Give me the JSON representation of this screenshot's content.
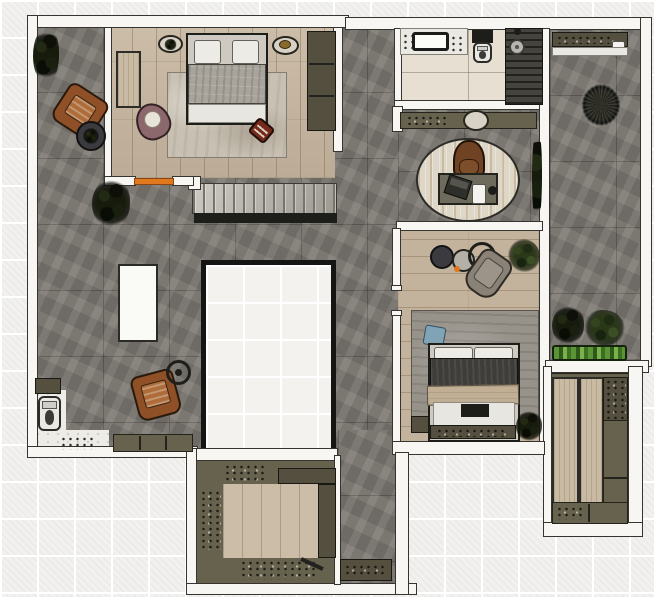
{
  "meta": {
    "title": "apartment-floor-plan-top-view-render",
    "canvas": {
      "width": 654,
      "height": 597
    }
  },
  "palette": {
    "background_tile": "#f2f1ef",
    "wall_white": "#f7f6f3",
    "concrete_gray": "#7b7670",
    "wood_light": "#c6b59f",
    "cabinet_olive": "#66624e",
    "accent_orange": "#e0781e",
    "plant_green": "#2a3818",
    "duvet_dark": "#3e3d3a",
    "leather_brown": "#8f5027"
  },
  "scene": [
    {
      "n": "living-room-floor",
      "c": "concrete",
      "x": 37,
      "y": 27,
      "w": 361,
      "h": 425
    },
    {
      "n": "corridor-bottom-floor",
      "c": "concrete",
      "x": 338,
      "y": 430,
      "w": 57,
      "h": 156
    },
    {
      "n": "office-floor",
      "c": "concrete",
      "x": 398,
      "y": 106,
      "w": 142,
      "h": 124
    },
    {
      "n": "bedroom-1-floor",
      "c": "wood-v",
      "x": 108,
      "y": 27,
      "w": 227,
      "h": 151
    },
    {
      "n": "bedroom-2-floor",
      "c": "wood-h",
      "x": 398,
      "y": 230,
      "w": 142,
      "h": 214
    },
    {
      "n": "bathroom-floor",
      "c": "tile-bath",
      "x": 398,
      "y": 28,
      "w": 145,
      "h": 78
    },
    {
      "n": "balcony-floor",
      "c": "concrete",
      "x": 550,
      "y": 30,
      "w": 94,
      "h": 332
    },
    {
      "n": "closet-floor",
      "c": "olive",
      "x": 549,
      "y": 373,
      "w": 82,
      "h": 152
    },
    {
      "n": "kitchen-floor",
      "c": "olive",
      "x": 196,
      "y": 460,
      "w": 140,
      "h": 124
    },
    {
      "n": "kitchen-wood-floor",
      "c": "wood-v2",
      "x": 223,
      "y": 484,
      "w": 95,
      "h": 74
    },
    {
      "n": "wc-floor-left",
      "c": "marble",
      "x": 33,
      "y": 390,
      "w": 33,
      "h": 62
    },
    {
      "n": "wc-floor-bottom",
      "c": "marble",
      "x": 33,
      "y": 430,
      "w": 76,
      "h": 22
    },
    {
      "n": "staircase",
      "c": "stairs",
      "x": 192,
      "y": 183,
      "w": 145,
      "h": 31
    },
    {
      "n": "staircase-edge",
      "c": "edge-dark",
      "x": 194,
      "y": 213,
      "w": 143,
      "h": 10
    },
    {
      "n": "stair-newel-cap",
      "c": "wall",
      "x": 188,
      "y": 176,
      "w": 13,
      "h": 14
    },
    {
      "n": "floor-void",
      "c": "void",
      "x": 201,
      "y": 260,
      "w": 135,
      "h": 194
    },
    {
      "n": "island-table",
      "c": "white-box",
      "x": 118,
      "y": 264,
      "w": 40,
      "h": 78
    },
    {
      "n": "wall-top-left",
      "c": "wall",
      "x": 27,
      "y": 15,
      "w": 322,
      "h": 13
    },
    {
      "n": "wall-top-right",
      "c": "wall",
      "x": 345,
      "y": 17,
      "w": 305,
      "h": 13
    },
    {
      "n": "wall-left",
      "c": "wall",
      "x": 27,
      "y": 15,
      "w": 11,
      "h": 440
    },
    {
      "n": "wall-living-bottom",
      "c": "wall",
      "x": 27,
      "y": 446,
      "w": 171,
      "h": 12
    },
    {
      "n": "wall-bedroom1-left",
      "c": "wall",
      "x": 104,
      "y": 27,
      "w": 8,
      "h": 152
    },
    {
      "n": "wall-bedroom1-bottom-a",
      "c": "wall",
      "x": 104,
      "y": 176,
      "w": 32,
      "h": 10
    },
    {
      "n": "wall-bedroom1-bottom-b",
      "c": "wall",
      "x": 172,
      "y": 176,
      "w": 22,
      "h": 10
    },
    {
      "n": "door-sill-bedroom1",
      "c": "orange",
      "x": 134,
      "y": 178,
      "w": 40,
      "h": 7
    },
    {
      "n": "wall-bedroom1-right",
      "c": "wall",
      "x": 333,
      "y": 27,
      "w": 10,
      "h": 125
    },
    {
      "n": "wall-bathroom-left",
      "c": "wall",
      "x": 394,
      "y": 28,
      "w": 8,
      "h": 78
    },
    {
      "n": "wall-bathroom-bottom",
      "c": "wall",
      "x": 394,
      "y": 100,
      "w": 150,
      "h": 10
    },
    {
      "n": "wall-office-tab",
      "c": "wall",
      "x": 392,
      "y": 106,
      "w": 11,
      "h": 26
    },
    {
      "n": "wall-mid-right",
      "c": "wall",
      "x": 539,
      "y": 28,
      "w": 11,
      "h": 424
    },
    {
      "n": "wall-balcony-right",
      "c": "wall",
      "x": 640,
      "y": 17,
      "w": 12,
      "h": 350
    },
    {
      "n": "wall-closet-top",
      "c": "wall",
      "x": 545,
      "y": 360,
      "w": 104,
      "h": 13
    },
    {
      "n": "wall-closet-right",
      "c": "wall",
      "x": 628,
      "y": 366,
      "w": 15,
      "h": 170
    },
    {
      "n": "wall-closet-left",
      "c": "wall",
      "x": 543,
      "y": 366,
      "w": 9,
      "h": 170
    },
    {
      "n": "wall-closet-bottom",
      "c": "wall",
      "x": 543,
      "y": 522,
      "w": 100,
      "h": 15
    },
    {
      "n": "wall-office-bedroom2",
      "c": "wall",
      "x": 396,
      "y": 221,
      "w": 147,
      "h": 10
    },
    {
      "n": "wall-living-right-upper",
      "c": "wall",
      "x": 392,
      "y": 228,
      "w": 9,
      "h": 60
    },
    {
      "n": "wall-living-right-lower",
      "c": "wall",
      "x": 392,
      "y": 312,
      "w": 9,
      "h": 132
    },
    {
      "n": "door-jamb-bedroom2-a",
      "c": "wall",
      "x": 391,
      "y": 285,
      "w": 11,
      "h": 6
    },
    {
      "n": "door-jamb-bedroom2-b",
      "c": "wall",
      "x": 391,
      "y": 310,
      "w": 11,
      "h": 6
    },
    {
      "n": "wall-bedroom2-bottom",
      "c": "wall",
      "x": 392,
      "y": 441,
      "w": 153,
      "h": 14
    },
    {
      "n": "wall-kitchen-top",
      "c": "wall",
      "x": 188,
      "y": 448,
      "w": 150,
      "h": 13
    },
    {
      "n": "wall-kitchen-left",
      "c": "wall",
      "x": 186,
      "y": 448,
      "w": 11,
      "h": 147
    },
    {
      "n": "wall-kitchen-bottom",
      "c": "wall",
      "x": 186,
      "y": 583,
      "w": 231,
      "h": 12
    },
    {
      "n": "wall-corridor-right",
      "c": "wall",
      "x": 395,
      "y": 452,
      "w": 14,
      "h": 143
    },
    {
      "n": "wall-kitchen-divider",
      "c": "wall",
      "x": 334,
      "y": 455,
      "w": 7,
      "h": 130
    },
    {
      "n": "bedroom1-side-panel",
      "c": "wood-panel",
      "x": 116,
      "y": 51,
      "w": 25,
      "h": 57
    },
    {
      "n": "bedroom1-rug",
      "c": "rug-light",
      "x": 167,
      "y": 72,
      "w": 120,
      "h": 86
    },
    {
      "n": "bed-1",
      "c": "bed-frame",
      "x": 186,
      "y": 33,
      "w": 82,
      "h": 92
    },
    {
      "n": "bed1-pillow-left",
      "c": "pillow",
      "x": 194,
      "y": 40,
      "w": 27,
      "h": 24
    },
    {
      "n": "bed1-pillow-right",
      "c": "pillow",
      "x": 232,
      "y": 40,
      "w": 27,
      "h": 24
    },
    {
      "n": "bed1-duvet",
      "c": "duvet-gray",
      "x": 188,
      "y": 64,
      "w": 78,
      "h": 40
    },
    {
      "n": "bed1-foot-sheet",
      "c": "sheet",
      "x": 188,
      "y": 104,
      "w": 78,
      "h": 19
    },
    {
      "n": "bed1-decor-tray-left",
      "c": "decor-oval",
      "x": 158,
      "y": 35,
      "w": 25,
      "h": 18
    },
    {
      "n": "bed1-decor-plant-left",
      "c": "plant-dark",
      "x": 164,
      "y": 39,
      "w": 13,
      "h": 11
    },
    {
      "n": "bed1-decor-tray-right",
      "c": "decor-oval",
      "x": 272,
      "y": 36,
      "w": 27,
      "h": 19
    },
    {
      "n": "bed1-decor-brass",
      "c": "brass",
      "x": 279,
      "y": 40,
      "w": 12,
      "h": 9
    },
    {
      "n": "bedroom1-wardrobe",
      "c": "olive-dark",
      "x": 307,
      "y": 31,
      "w": 29,
      "h": 100
    },
    {
      "n": "wardrobe-divider-1",
      "c": "line-dark",
      "x": 309,
      "y": 63,
      "w": 25,
      "h": 2
    },
    {
      "n": "wardrobe-divider-2",
      "c": "line-dark",
      "x": 309,
      "y": 95,
      "w": 25,
      "h": 2
    },
    {
      "n": "bedroom1-armchair",
      "c": "chair-mauve",
      "x": 136,
      "y": 103,
      "w": 34,
      "h": 37,
      "rot": -25
    },
    {
      "n": "bedroom1-ottoman",
      "c": "ottoman",
      "x": 251,
      "y": 121,
      "w": 21,
      "h": 19,
      "rot": 40
    },
    {
      "n": "living-plant-top",
      "c": "plant-dark",
      "x": 33,
      "y": 27,
      "w": 26,
      "h": 56
    },
    {
      "n": "living-armchair-1",
      "c": "chair-brown",
      "x": 57,
      "y": 89,
      "w": 46,
      "h": 44,
      "rot": 33
    },
    {
      "n": "living-side-table-1",
      "c": "table-dark",
      "x": 76,
      "y": 121,
      "w": 30,
      "h": 30
    },
    {
      "n": "living-table-plant",
      "c": "plant-dark",
      "x": 83,
      "y": 128,
      "w": 16,
      "h": 16
    },
    {
      "n": "living-plant-2",
      "c": "plant-dark",
      "x": 92,
      "y": 178,
      "w": 38,
      "h": 50
    },
    {
      "n": "living-armchair-2",
      "c": "chair-brown",
      "x": 134,
      "y": 372,
      "w": 44,
      "h": 46,
      "rot": -15
    },
    {
      "n": "living-side-table-2",
      "c": "table-ring",
      "x": 166,
      "y": 360,
      "w": 25,
      "h": 25
    },
    {
      "n": "living-table2-dot",
      "c": "dot-dark",
      "x": 175,
      "y": 369,
      "w": 7,
      "h": 7
    },
    {
      "n": "wc-shelf",
      "c": "olive-dark",
      "x": 35,
      "y": 378,
      "w": 26,
      "h": 16
    },
    {
      "n": "wc-toilet",
      "c": "toilet",
      "x": 38,
      "y": 396,
      "w": 23,
      "h": 35
    },
    {
      "n": "wc-scatter-items",
      "c": "speck-dark",
      "x": 60,
      "y": 436,
      "w": 34,
      "h": 14
    },
    {
      "n": "living-sideboard",
      "c": "olive",
      "x": 113,
      "y": 434,
      "w": 80,
      "h": 18
    },
    {
      "n": "sideboard-div-1",
      "c": "line-dark",
      "x": 139,
      "y": 436,
      "w": 2,
      "h": 14
    },
    {
      "n": "sideboard-div-2",
      "c": "line-dark",
      "x": 165,
      "y": 436,
      "w": 2,
      "h": 14
    },
    {
      "n": "office-console",
      "c": "olive",
      "x": 400,
      "y": 112,
      "w": 137,
      "h": 17
    },
    {
      "n": "office-console-items",
      "c": "speck-dark",
      "x": 406,
      "y": 115,
      "w": 40,
      "h": 10
    },
    {
      "n": "office-console-decor",
      "c": "decor-oval",
      "x": 463,
      "y": 110,
      "w": 26,
      "h": 21
    },
    {
      "n": "office-rug",
      "c": "rug-oval",
      "x": 416,
      "y": 138,
      "w": 104,
      "h": 84
    },
    {
      "n": "office-chair",
      "c": "office-chair",
      "x": 453,
      "y": 140,
      "w": 32,
      "h": 40
    },
    {
      "n": "office-desk",
      "c": "desk",
      "x": 438,
      "y": 173,
      "w": 60,
      "h": 32
    },
    {
      "n": "office-laptop",
      "c": "laptop",
      "x": 446,
      "y": 177,
      "w": 24,
      "h": 20,
      "rot": 18
    },
    {
      "n": "office-notepad",
      "c": "cup",
      "x": 472,
      "y": 184,
      "w": 14,
      "h": 20
    },
    {
      "n": "office-desk-item",
      "c": "dot-dark",
      "x": 488,
      "y": 186,
      "w": 9,
      "h": 9
    },
    {
      "n": "office-plant-strip",
      "c": "plant-dark",
      "x": 532,
      "y": 128,
      "w": 10,
      "h": 96
    },
    {
      "n": "bath-vanity",
      "c": "shelf-white",
      "x": 400,
      "y": 28,
      "w": 68,
      "h": 27
    },
    {
      "n": "bath-sink",
      "c": "sink-rect",
      "x": 412,
      "y": 32,
      "w": 37,
      "h": 19
    },
    {
      "n": "bath-vanity-items-left",
      "c": "speck-dark",
      "x": 402,
      "y": 33,
      "w": 10,
      "h": 16
    },
    {
      "n": "bath-vanity-items-right",
      "c": "speck-dark",
      "x": 450,
      "y": 35,
      "w": 15,
      "h": 17
    },
    {
      "n": "bath-toilet-tank",
      "c": "edge-dark",
      "x": 472,
      "y": 30,
      "w": 21,
      "h": 13
    },
    {
      "n": "bath-toilet",
      "c": "toilet",
      "x": 473,
      "y": 42,
      "w": 19,
      "h": 21
    },
    {
      "n": "shower-floor",
      "c": "slats-dark",
      "x": 505,
      "y": 28,
      "w": 38,
      "h": 77
    },
    {
      "n": "shower-head",
      "c": "showerhead",
      "x": 509,
      "y": 39,
      "w": 16,
      "h": 16
    },
    {
      "n": "shower-valve",
      "c": "dot-dark",
      "x": 514,
      "y": 28,
      "w": 7,
      "h": 7
    },
    {
      "n": "bedroom2-table-dark",
      "c": "table-dark",
      "x": 430,
      "y": 245,
      "w": 24,
      "h": 24
    },
    {
      "n": "bedroom2-table-gray",
      "c": "table-gray",
      "x": 452,
      "y": 249,
      "w": 23,
      "h": 23
    },
    {
      "n": "bedroom2-table-ring",
      "c": "table-ring",
      "x": 468,
      "y": 242,
      "w": 28,
      "h": 28
    },
    {
      "n": "bedroom2-orange-dot",
      "c": "orange-dot",
      "x": 454,
      "y": 266,
      "w": 6,
      "h": 6
    },
    {
      "n": "bedroom2-armchair",
      "c": "chair-gray",
      "x": 470,
      "y": 251,
      "w": 36,
      "h": 46,
      "rot": 35
    },
    {
      "n": "bedroom2-plant",
      "c": "plant",
      "x": 508,
      "y": 239,
      "w": 32,
      "h": 34
    },
    {
      "n": "bedroom2-rug",
      "c": "rug-gray",
      "x": 411,
      "y": 310,
      "w": 128,
      "h": 112
    },
    {
      "n": "bedroom2-cushion",
      "c": "cushion-blue",
      "x": 424,
      "y": 326,
      "w": 21,
      "h": 20,
      "rot": 10
    },
    {
      "n": "bed-2",
      "c": "bed-frame",
      "x": 428,
      "y": 343,
      "w": 92,
      "h": 99
    },
    {
      "n": "bed2-pillow-left",
      "c": "pillow",
      "x": 434,
      "y": 347,
      "w": 39,
      "h": 13
    },
    {
      "n": "bed2-pillow-right",
      "c": "pillow",
      "x": 474,
      "y": 347,
      "w": 39,
      "h": 13
    },
    {
      "n": "bed2-duvet",
      "c": "duvet-dark",
      "x": 430,
      "y": 358,
      "w": 88,
      "h": 32
    },
    {
      "n": "bed2-throw",
      "c": "throw",
      "x": 427,
      "y": 385,
      "w": 92,
      "h": 20,
      "rot": -1
    },
    {
      "n": "bed2-foot-sheet",
      "c": "sheet",
      "x": 433,
      "y": 402,
      "w": 82,
      "h": 24
    },
    {
      "n": "bed2-bench",
      "c": "edge-dark",
      "x": 461,
      "y": 404,
      "w": 28,
      "h": 13
    },
    {
      "n": "bed2-foot-ledge",
      "c": "olive-dark",
      "x": 430,
      "y": 425,
      "w": 86,
      "h": 14
    },
    {
      "n": "bed2-ledge-items",
      "c": "speck-dark",
      "x": 436,
      "y": 428,
      "w": 70,
      "h": 9
    },
    {
      "n": "bedroom2-nightstand",
      "c": "olive-dark",
      "x": 411,
      "y": 416,
      "w": 18,
      "h": 17
    },
    {
      "n": "bedroom2-plant-corner",
      "c": "plant-dark",
      "x": 516,
      "y": 410,
      "w": 26,
      "h": 32
    },
    {
      "n": "balcony-shelf",
      "c": "olive-dark",
      "x": 552,
      "y": 32,
      "w": 76,
      "h": 15
    },
    {
      "n": "balcony-shelf-items",
      "c": "speck-dark",
      "x": 556,
      "y": 35,
      "w": 58,
      "h": 9
    },
    {
      "n": "balcony-bowl",
      "c": "cup",
      "x": 612,
      "y": 41,
      "w": 13,
      "h": 8
    },
    {
      "n": "balcony-ledge",
      "c": "shelf-white",
      "x": 552,
      "y": 47,
      "w": 76,
      "h": 9
    },
    {
      "n": "balcony-hanging-chair",
      "c": "wicker",
      "x": 576,
      "y": 78,
      "w": 50,
      "h": 54
    },
    {
      "n": "balcony-plant-a",
      "c": "plant-dark",
      "x": 552,
      "y": 305,
      "w": 32,
      "h": 40
    },
    {
      "n": "balcony-plant-b",
      "c": "plant",
      "x": 583,
      "y": 310,
      "w": 42,
      "h": 36
    },
    {
      "n": "balcony-planter",
      "c": "planter",
      "x": 552,
      "y": 345,
      "w": 75,
      "h": 16
    },
    {
      "n": "closet-wood-panel-a",
      "c": "wood-panel",
      "x": 552,
      "y": 377,
      "w": 27,
      "h": 127
    },
    {
      "n": "closet-wood-panel-b",
      "c": "wood-panel",
      "x": 579,
      "y": 377,
      "w": 25,
      "h": 127
    },
    {
      "n": "closet-cabinet-top",
      "c": "olive-dark",
      "x": 603,
      "y": 377,
      "w": 25,
      "h": 44
    },
    {
      "n": "closet-cabinet-top-items",
      "c": "speck-dark",
      "x": 605,
      "y": 379,
      "w": 21,
      "h": 40
    },
    {
      "n": "closet-cabinet-mid",
      "c": "olive",
      "x": 603,
      "y": 420,
      "w": 25,
      "h": 58
    },
    {
      "n": "closet-cabinet-low",
      "c": "olive",
      "x": 603,
      "y": 478,
      "w": 25,
      "h": 26
    },
    {
      "n": "closet-cabinet-bottom",
      "c": "olive",
      "x": 552,
      "y": 502,
      "w": 76,
      "h": 22
    },
    {
      "n": "closet-bottom-div",
      "c": "line-dark",
      "x": 588,
      "y": 504,
      "w": 2,
      "h": 18
    },
    {
      "n": "closet-bottom-items",
      "c": "speck-dark",
      "x": 556,
      "y": 506,
      "w": 28,
      "h": 14
    },
    {
      "n": "kitchen-shelf-tier",
      "c": "olive-dark",
      "x": 278,
      "y": 468,
      "w": 58,
      "h": 16
    },
    {
      "n": "kitchen-counter-items-top",
      "c": "speck-dark",
      "x": 224,
      "y": 464,
      "w": 40,
      "h": 18
    },
    {
      "n": "kitchen-counter-items-left",
      "c": "speck-dark",
      "x": 200,
      "y": 490,
      "w": 21,
      "h": 60
    },
    {
      "n": "kitchen-right-strip",
      "c": "olive-dark",
      "x": 318,
      "y": 484,
      "w": 18,
      "h": 74
    },
    {
      "n": "kitchen-counter-items-bottom",
      "c": "speck-dark",
      "x": 240,
      "y": 560,
      "w": 76,
      "h": 20
    },
    {
      "n": "kitchen-utensil",
      "c": "line-dark",
      "x": 300,
      "y": 562,
      "w": 24,
      "h": 4,
      "rot": 25
    },
    {
      "n": "hall-console",
      "c": "olive-dark",
      "x": 340,
      "y": 559,
      "w": 52,
      "h": 22
    },
    {
      "n": "hall-console-items",
      "c": "speck-dark",
      "x": 344,
      "y": 564,
      "w": 44,
      "h": 11
    }
  ]
}
